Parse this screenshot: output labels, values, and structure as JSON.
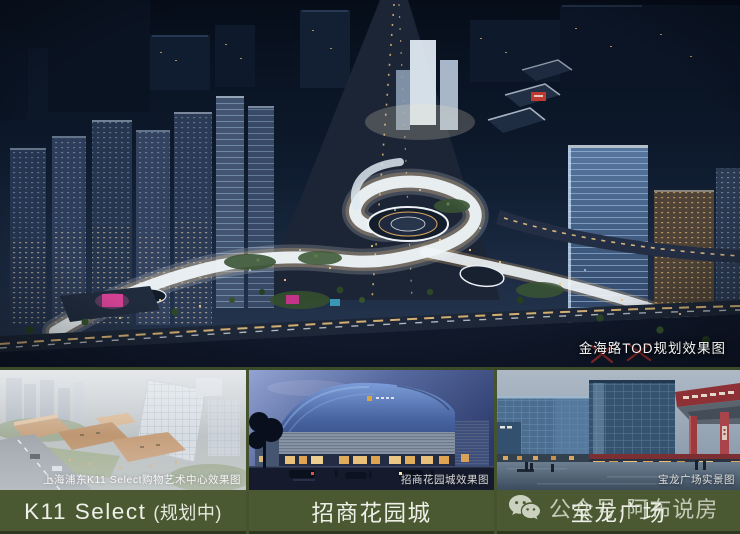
{
  "page": {
    "type": "promotional-image-collage",
    "topic": "金海路TOD商业配套"
  },
  "main_render": {
    "watermark_label": "金海路TOD规划效果图"
  },
  "gallery": {
    "items": [
      {
        "caption": "K11 Select",
        "caption_suffix": "(规划中)",
        "photo_watermark": "上海浦东K11 Select购物艺术中心效果图"
      },
      {
        "caption": "招商花园城",
        "caption_suffix": "",
        "photo_watermark": "招商花园城效果图"
      },
      {
        "caption": "宝龙广场",
        "caption_suffix": "",
        "photo_watermark": "宝龙广场实景图"
      }
    ]
  },
  "account_watermark": {
    "icon": "wechat-icon",
    "text": "公众号·阿布说房"
  },
  "colors": {
    "caption_band_green": "#4b5933",
    "separator_green": "#3b4a28",
    "caption_text": "#eef0e8",
    "watermark_text": "#e2e5d8",
    "accent_magenta": "#d1378f",
    "annotation_red": "#b5342e",
    "night_sky": "#0e1b2e"
  }
}
